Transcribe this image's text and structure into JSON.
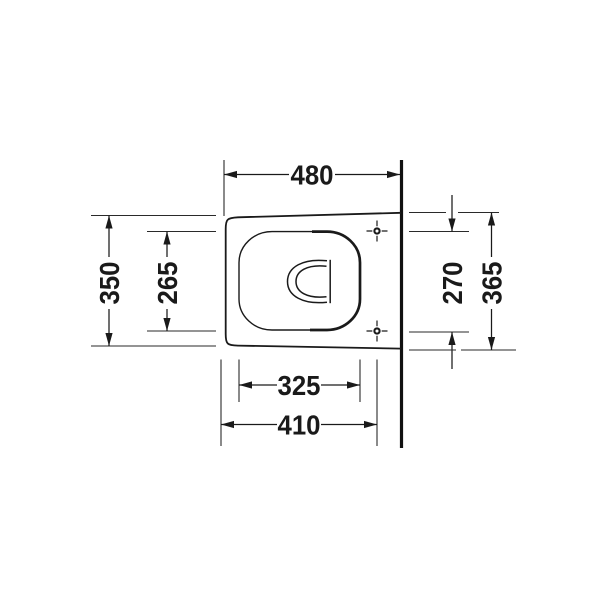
{
  "drawing": {
    "background": "#ffffff",
    "line_color": "#1a1a1a",
    "labels": {
      "width_overall": "480",
      "depth_front": "350",
      "depth_seat_inner": "265",
      "hole_spacing": "270",
      "depth_at_wall": "365",
      "seat_inner_width": "325",
      "hole_axis_offset": "410"
    },
    "icons": {
      "mounting_hole": "crosshair-icon"
    }
  }
}
